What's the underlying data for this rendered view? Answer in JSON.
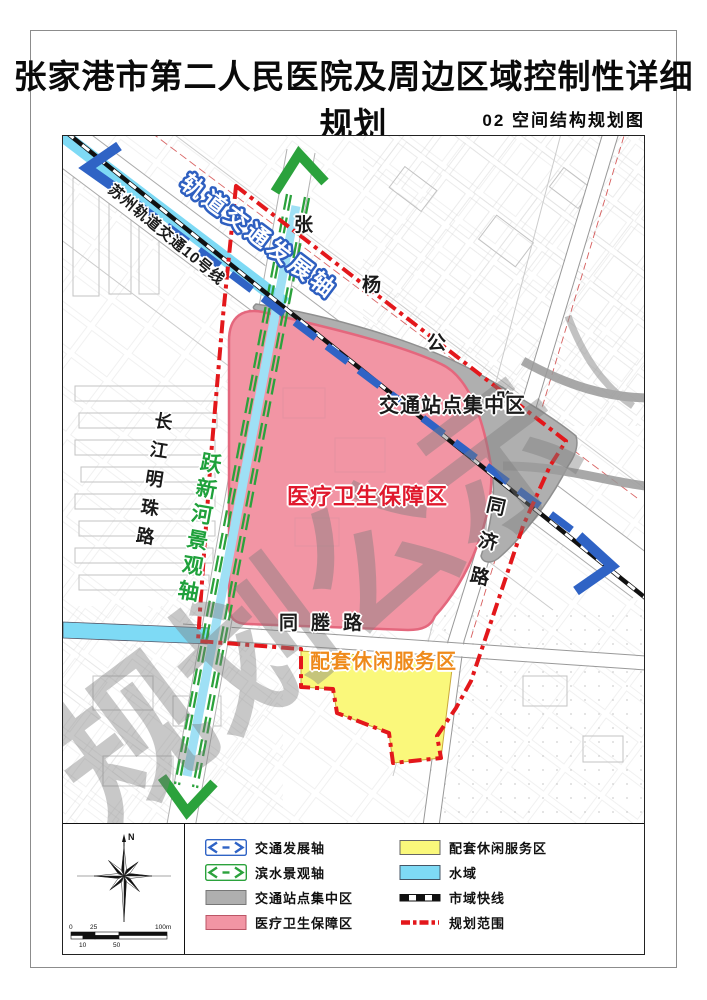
{
  "page": {
    "title": "张家港市第二人民医院及周边区域控制性详细规划",
    "subtitle": "02 空间结构规划图"
  },
  "map": {
    "labels": {
      "rail_axis": "轨道交通发展轴",
      "suzhou_line": "苏州轨道交通10号线",
      "station_area": "交通站点集中区",
      "medical_area": "医疗卫生保障区",
      "leisure_area": "配套休闲服务区",
      "river_axis": "跃新河景观轴",
      "watermark": "规划公示",
      "roads": {
        "zhangyang": [
          "张",
          "杨",
          "公",
          "路"
        ],
        "changjiang_mingzhu": "长江明珠路",
        "tongcheng": "同塍路",
        "tongji": "同济路"
      }
    }
  },
  "compass": {
    "north": "N"
  },
  "scalebar": {
    "top": [
      "0",
      "25",
      "100m"
    ],
    "bottom": [
      "10",
      "50"
    ]
  },
  "legend": {
    "left": [
      "交通发展轴",
      "滨水景观轴",
      "交通站点集中区",
      "医疗卫生保障区"
    ],
    "right": [
      "配套休闲服务区",
      "水域",
      "市域快线",
      "规划范围"
    ]
  },
  "colors": {
    "axis_blue": "#2F63C5",
    "axis_green": "#2BA23C",
    "boundary_red": "#E3171B",
    "station_gray": "#AFAFAF",
    "medical_pink": "#F295A4",
    "leisure_yellow": "#FAF87B",
    "water_cyan": "#7EDAF5",
    "medical_label_red": "#E0192D",
    "leisure_label_orange": "#EF8A1A",
    "river_label_green": "#1FA13B",
    "express_line_black": "#111111"
  }
}
